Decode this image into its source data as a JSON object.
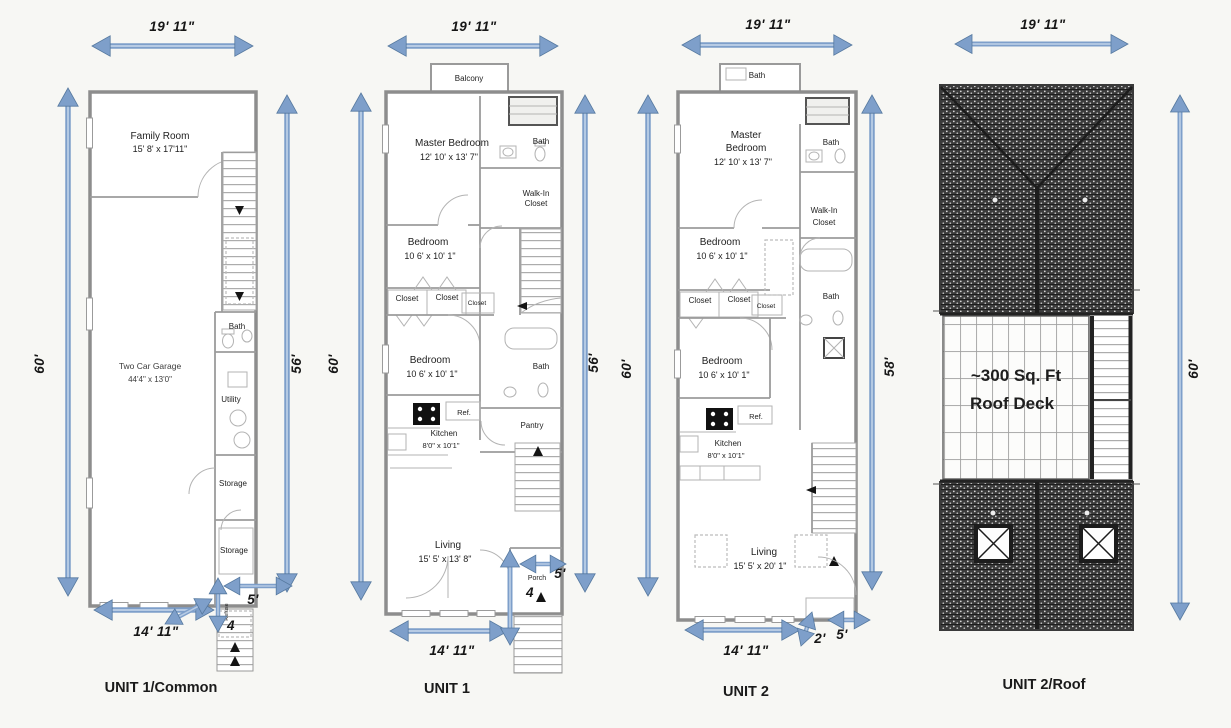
{
  "colors": {
    "arrow": "#7e9fca",
    "arrow_dark": "#56799f",
    "arrow_light": "#b7cbe4",
    "roof_dark": "#3c3c3c",
    "background": "#f7f7f4"
  },
  "u1c": {
    "title": "UNIT 1/Common",
    "dim_top": "19' 11\"",
    "dim_left": "60'",
    "dim_right": "56'",
    "dim_bottom": "14' 11\"",
    "dim_w": "5'",
    "dim_d": "4",
    "family_name": "Family Room",
    "family_size": "15' 8' x 17'11\"",
    "garage_name": "Two Car Garage",
    "garage_size": "44'4\" x 13'0\"",
    "bath": "Bath",
    "utility": "Utility",
    "storage1": "Storage",
    "storage2": "Storage",
    "refuse": "Refuse"
  },
  "u1": {
    "title": "UNIT 1",
    "dim_top": "19' 11\"",
    "dim_left": "60'",
    "dim_right": "56'",
    "dim_bottom": "14' 11\"",
    "dim_w": "5'",
    "dim_d": "4",
    "balcony": "Balcony",
    "master_name": "Master Bedroom",
    "master_size": "12' 10' x 13' 7\"",
    "bath_upper": "Bath",
    "walkin1": "Walk-In",
    "walkin2": "Closet",
    "bed1_name": "Bedroom",
    "bed1_size": "10 6' x 10' 1\"",
    "closet1": "Closet",
    "closet2": "Closet",
    "closet3": "Closet",
    "bed2_name": "Bedroom",
    "bed2_size": "10 6' x 10' 1\"",
    "bath_mid": "Bath",
    "kitchen_name": "Kitchen",
    "kitchen_size": "8'0\" x 10'1\"",
    "ref": "Ref.",
    "pantry": "Pantry",
    "living_name": "Living",
    "living_size": "15' 5' x 13' 8\"",
    "porch": "Porch"
  },
  "u2": {
    "title": "UNIT 2",
    "dim_top": "19' 11\"",
    "dim_left": "60'",
    "dim_right": "58'",
    "dim_bottom": "14' 11\"",
    "dim_w": "5'",
    "dim_d": "2'",
    "bath_top": "Bath",
    "master1": "Master",
    "master2": "Bedroom",
    "master_size": "12' 10' x 13' 7\"",
    "bath_upper": "Bath",
    "walkin1": "Walk-In",
    "walkin2": "Closet",
    "bed1_name": "Bedroom",
    "bed1_size": "10 6' x 10' 1\"",
    "closet1": "Closet",
    "closet2": "Closet",
    "closet3": "Closet",
    "bed2_name": "Bedroom",
    "bed2_size": "10 6' x 10' 1\"",
    "bath_mid": "Bath",
    "kitchen_name": "Kitchen",
    "kitchen_size": "8'0\" x 10'1\"",
    "ref": "Ref.",
    "living_name": "Living",
    "living_size": "15' 5' x 20' 1\""
  },
  "roof": {
    "title": "UNIT 2/Roof",
    "dim_top": "19' 11\"",
    "dim_right": "60'",
    "deck1": "~300 Sq. Ft",
    "deck2": "Roof Deck"
  }
}
